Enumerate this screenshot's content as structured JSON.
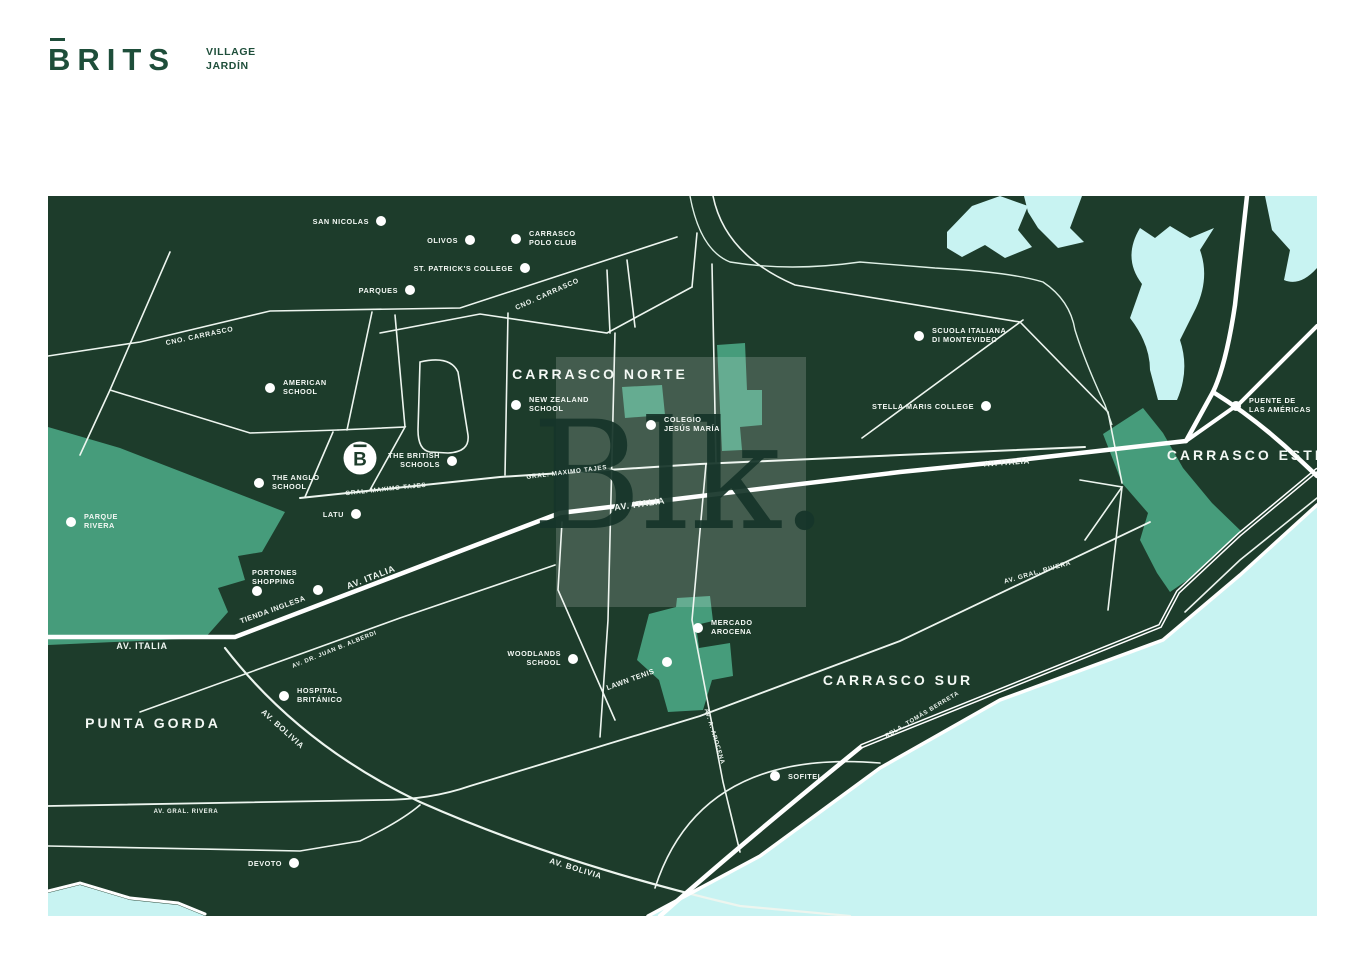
{
  "logo": {
    "brand": "BRITS",
    "tagline": [
      "VILLAGE",
      "JARDÍN"
    ],
    "color": "#1e4e3a"
  },
  "colors": {
    "page_background": "#ffffff",
    "land": "#1d3c2b",
    "park": "#469c7b",
    "water": "#c8f3f2",
    "road_thick": "#ffffff",
    "road_thin": "#edf5ef",
    "label_text": "#f3f8f4",
    "logo_green": "#1e4e3a",
    "watermark_text": "#16352a"
  },
  "watermark": {
    "text": "Blk."
  },
  "map": {
    "marker": {
      "letter": "B",
      "x": 360,
      "y": 458
    },
    "districts": [
      {
        "label": "CARRASCO NORTE",
        "x": 600,
        "y": 379
      },
      {
        "label": "CARRASCO ESTE",
        "x": 1247,
        "y": 460
      },
      {
        "label": "CARRASCO SUR",
        "x": 898,
        "y": 685
      },
      {
        "label": "PUNTA GORDA",
        "x": 153,
        "y": 728
      }
    ],
    "road_labels": [
      {
        "label": "CNO. CARRASCO",
        "x": 200,
        "y": 338,
        "angle": -12,
        "size": 7
      },
      {
        "label": "CNO. CARRASCO",
        "x": 548,
        "y": 296,
        "angle": -24,
        "size": 7
      },
      {
        "label": "GRAL. MAXIMO TAJES",
        "x": 386,
        "y": 491,
        "angle": -6,
        "size": 6.3
      },
      {
        "label": "GRAL. MAXIMO TAJES",
        "x": 567,
        "y": 474,
        "angle": -7,
        "size": 6.3
      },
      {
        "label": "AV. ITALIA",
        "x": 142,
        "y": 649,
        "angle": 0,
        "size": 9
      },
      {
        "label": "AV. ITALIA",
        "x": 372,
        "y": 580,
        "angle": -21,
        "size": 9
      },
      {
        "label": "AV. ITALIA",
        "x": 640,
        "y": 507,
        "angle": -8,
        "size": 9
      },
      {
        "label": "AV. ITALIA",
        "x": 1007,
        "y": 465,
        "angle": -4,
        "size": 8
      },
      {
        "label": "AV. DR. JUAN B. ALBERDI",
        "x": 335,
        "y": 651,
        "angle": -22,
        "size": 6
      },
      {
        "label": "AV. BOLIVIA",
        "x": 281,
        "y": 731,
        "angle": 42,
        "size": 8
      },
      {
        "label": "AV. BOLIVIA",
        "x": 575,
        "y": 871,
        "angle": 17,
        "size": 8
      },
      {
        "label": "AV. GRAL. RIVERA",
        "x": 186,
        "y": 813,
        "angle": 0,
        "size": 6
      },
      {
        "label": "AV. GRAL. RIVERA",
        "x": 1038,
        "y": 574,
        "angle": -16,
        "size": 6.5
      },
      {
        "label": "RBLA. TOMÁS BERRETA",
        "x": 923,
        "y": 716,
        "angle": -31,
        "size": 6
      },
      {
        "label": "AV. A. AROCENA",
        "x": 713,
        "y": 737,
        "angle": 73,
        "size": 6
      }
    ],
    "pois": [
      {
        "id": "san-nicolas",
        "lines": [
          "SAN NICOLAS"
        ],
        "dot": [
          381,
          221
        ],
        "text": {
          "x": 369,
          "y": 224,
          "anchor": "end"
        }
      },
      {
        "id": "olivos",
        "lines": [
          "OLIVOS"
        ],
        "dot": [
          470,
          240
        ],
        "text": {
          "x": 458,
          "y": 243,
          "anchor": "end"
        }
      },
      {
        "id": "carrasco-polo-club",
        "lines": [
          "CARRASCO",
          "POLO CLUB"
        ],
        "dot": [
          516,
          239
        ],
        "text": {
          "x": 529,
          "y": 236,
          "anchor": "start"
        }
      },
      {
        "id": "st-patricks-college",
        "lines": [
          "ST. PATRICK'S COLLEGE"
        ],
        "dot": [
          525,
          268
        ],
        "text": {
          "x": 513,
          "y": 271,
          "anchor": "end"
        }
      },
      {
        "id": "parques",
        "lines": [
          "PARQUES"
        ],
        "dot": [
          410,
          290
        ],
        "text": {
          "x": 398,
          "y": 293,
          "anchor": "end"
        }
      },
      {
        "id": "american-school",
        "lines": [
          "AMERICAN",
          "SCHOOL"
        ],
        "dot": [
          270,
          388
        ],
        "text": {
          "x": 283,
          "y": 385,
          "anchor": "start"
        }
      },
      {
        "id": "new-zealand-school",
        "lines": [
          "NEW ZEALAND",
          "SCHOOL"
        ],
        "dot": [
          516,
          405
        ],
        "text": {
          "x": 529,
          "y": 402,
          "anchor": "start"
        }
      },
      {
        "id": "colegio-jesus-maria",
        "lines": [
          "COLEGIO",
          "JESÚS MARÍA"
        ],
        "dot": [
          651,
          425
        ],
        "text": {
          "x": 664,
          "y": 422,
          "anchor": "start"
        }
      },
      {
        "id": "scuola-italiana",
        "lines": [
          "SCUOLA ITALIANA",
          "DI MONTEVIDEO"
        ],
        "dot": [
          919,
          336
        ],
        "text": {
          "x": 932,
          "y": 333,
          "anchor": "start"
        }
      },
      {
        "id": "stella-maris-college",
        "lines": [
          "STELLA MARIS COLLEGE"
        ],
        "dot": [
          986,
          406
        ],
        "text": {
          "x": 974,
          "y": 409,
          "anchor": "end"
        }
      },
      {
        "id": "puente-de-las-americas",
        "lines": [
          "PUENTE DE",
          "LAS AMÉRICAS"
        ],
        "dot": [
          1236,
          406
        ],
        "text": {
          "x": 1249,
          "y": 403,
          "anchor": "start"
        }
      },
      {
        "id": "the-british-schools",
        "lines": [
          "THE BRITISH",
          "SCHOOLS"
        ],
        "dot": [
          452,
          461
        ],
        "text": {
          "x": 440,
          "y": 458,
          "anchor": "end"
        }
      },
      {
        "id": "the-anglo-school",
        "lines": [
          "THE ANGLO",
          "SCHOOL"
        ],
        "dot": [
          259,
          483
        ],
        "text": {
          "x": 272,
          "y": 480,
          "anchor": "start"
        }
      },
      {
        "id": "latu",
        "lines": [
          "LATU"
        ],
        "dot": [
          356,
          514
        ],
        "text": {
          "x": 344,
          "y": 517,
          "anchor": "end"
        }
      },
      {
        "id": "parque-rivera",
        "lines": [
          "PARQUE",
          "RIVERA"
        ],
        "dot": [
          71,
          522
        ],
        "text": {
          "x": 84,
          "y": 519,
          "anchor": "start"
        }
      },
      {
        "id": "portones-shopping",
        "lines": [
          "PORTONES",
          "SHOPPING"
        ],
        "dot": [
          257,
          591
        ],
        "text": {
          "x": 252,
          "y": 575,
          "anchor": "start"
        }
      },
      {
        "id": "tienda-inglesa",
        "lines": [
          "TIENDA INGLESA"
        ],
        "dot": [
          318,
          590
        ],
        "text": {
          "x": 306,
          "y": 600,
          "anchor": "end",
          "angle": -20
        }
      },
      {
        "id": "woodlands-school",
        "lines": [
          "WOODLANDS",
          "SCHOOL"
        ],
        "dot": [
          573,
          659
        ],
        "text": {
          "x": 561,
          "y": 656,
          "anchor": "end"
        }
      },
      {
        "id": "lawn-tenis",
        "lines": [
          "LAWN TENIS"
        ],
        "dot": [
          667,
          662
        ],
        "text": {
          "x": 655,
          "y": 673,
          "anchor": "end",
          "angle": -20
        }
      },
      {
        "id": "mercado-arocena",
        "lines": [
          "MERCADO",
          "AROCENA"
        ],
        "dot": [
          698,
          628
        ],
        "text": {
          "x": 711,
          "y": 625,
          "anchor": "start"
        }
      },
      {
        "id": "hospital-britanico",
        "lines": [
          "HOSPITAL",
          "BRITÁNICO"
        ],
        "dot": [
          284,
          696
        ],
        "text": {
          "x": 297,
          "y": 693,
          "anchor": "start"
        }
      },
      {
        "id": "sofitel",
        "lines": [
          "SOFITEL"
        ],
        "dot": [
          775,
          776
        ],
        "text": {
          "x": 788,
          "y": 779,
          "anchor": "start"
        }
      },
      {
        "id": "devoto",
        "lines": [
          "DEVOTO"
        ],
        "dot": [
          294,
          863
        ],
        "text": {
          "x": 282,
          "y": 866,
          "anchor": "end"
        }
      }
    ]
  }
}
